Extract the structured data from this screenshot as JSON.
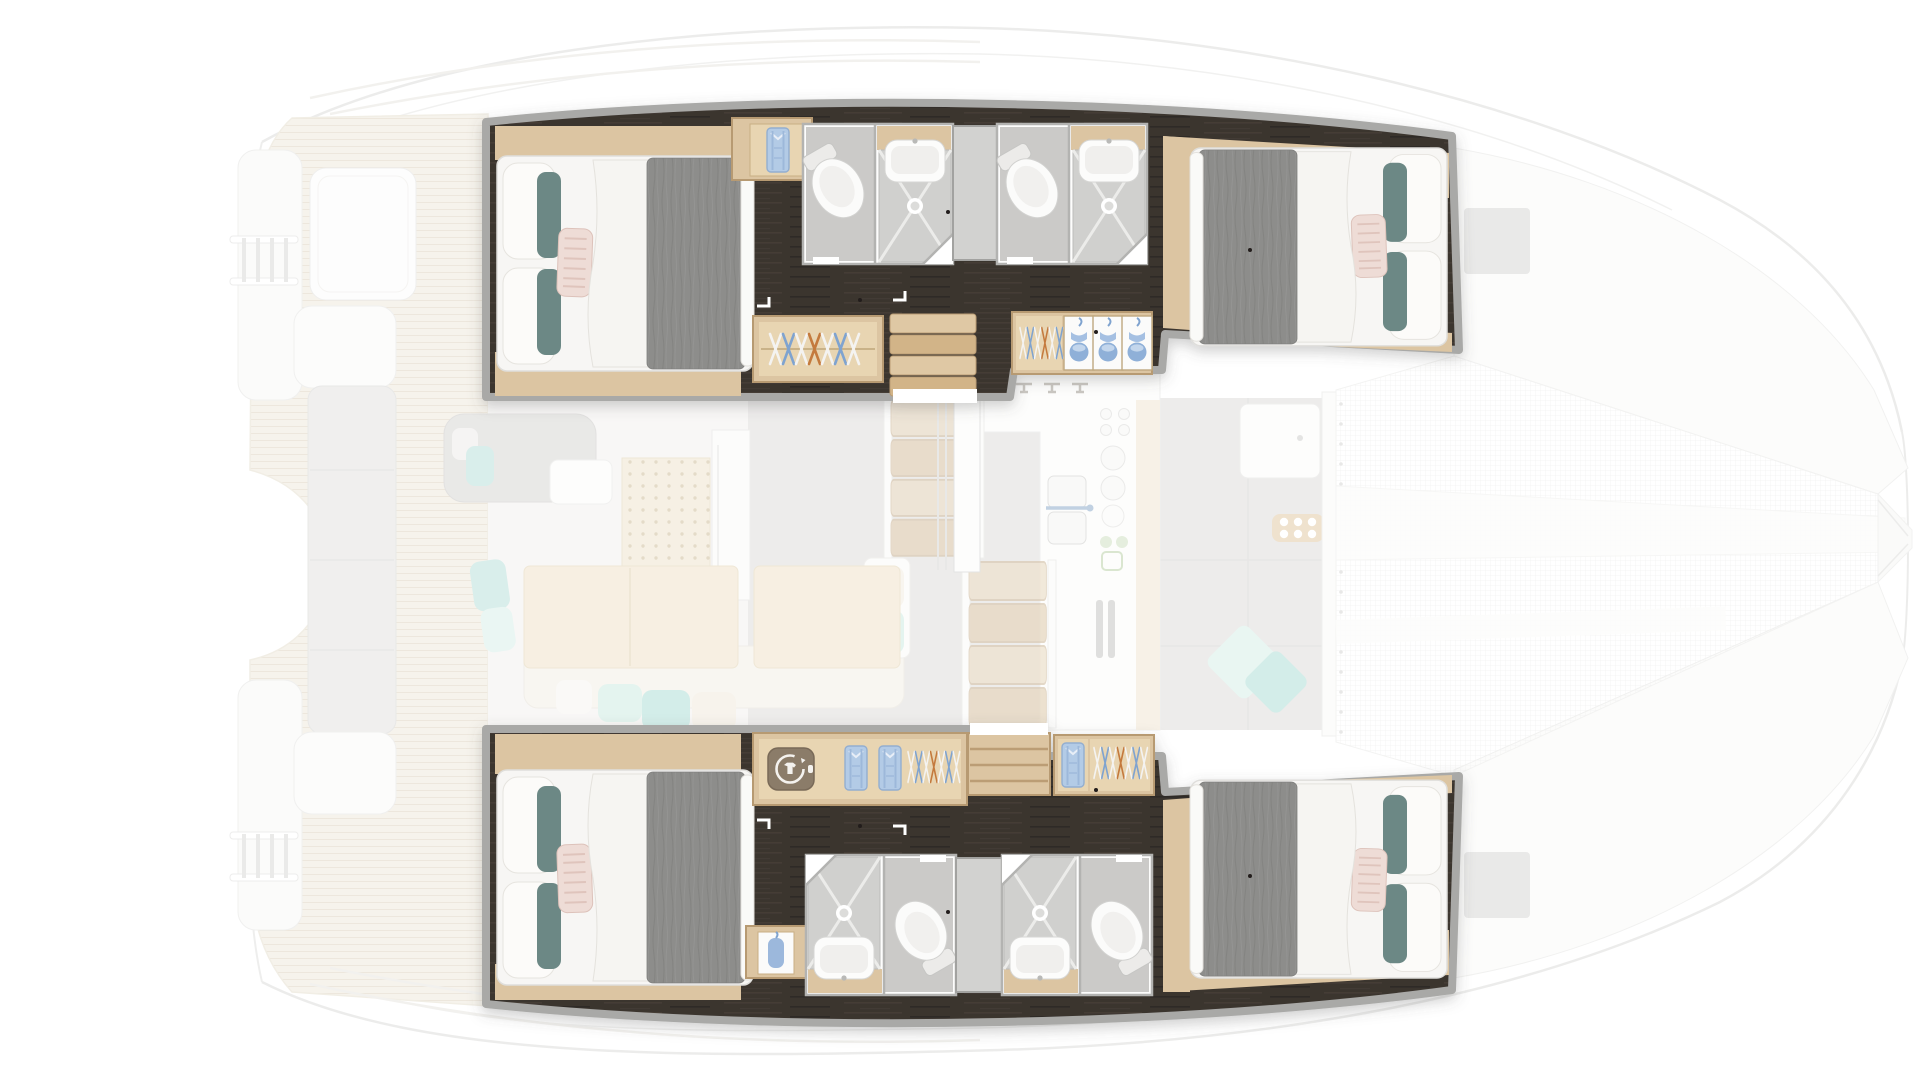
{
  "title": "Catamaran yacht floor plan — 4-cabin version, top view; hull accommodations highlighted, deck and salon ghosted",
  "type": "boat-deck-plan",
  "colors": {
    "wall": "#a9a9a7",
    "floor-dark": "#3b342f",
    "wood": "#dcc5a2",
    "wood-light": "#e8d5b2",
    "wood-deep": "#b79a72",
    "linen": "#f7f6f4",
    "duvet": "#8d8d8b",
    "pillow-teal": "#6c8885",
    "pillow-blush": "#eedcd6",
    "bath-floor": "#cbcac8",
    "shower-tray": "#d0d0ce",
    "divider-door": "#d2d2d0",
    "hanger-blue": "#7fa3cf",
    "hanger-orange": "#c47a3e",
    "shirt-blue": "#b3cbe6",
    "wm-plate": "#8b7b69",
    "teak": "#efe9dc",
    "teak-line": "#ded3bf",
    "salon-gray": "#dddcda",
    "cushion-teal": "#abddd6",
    "cushion-mint": "#cdebe2",
    "table-wood": "#f0e2c8",
    "table-edge": "#e2d2b2",
    "mesh-line": "#e7e7e5",
    "fade-stroke": "#dcdcda"
  },
  "plan": {
    "hulls": [
      {
        "id": "port",
        "position": "top",
        "rooms": [
          {
            "type": "double-cabin",
            "location": "aft",
            "items": [
              "double-bed",
              "gray-duvet",
              "white-duvet-fold",
              "white-pillows",
              "teal-bolster-pillows",
              "striped-blush-pillow",
              "wood-shelf",
              "wood-floor"
            ]
          },
          {
            "type": "closet",
            "items": [
              "folded-blue-shirt"
            ]
          },
          {
            "type": "bathroom",
            "items": [
              "toilet",
              "washbasin",
              "shower-tray",
              "vanity"
            ]
          },
          {
            "type": "sliding-door-panel"
          },
          {
            "type": "bathroom",
            "items": [
              "toilet",
              "washbasin",
              "shower-tray",
              "vanity"
            ]
          },
          {
            "type": "wardrobe",
            "items": [
              "clothes-hangers"
            ]
          },
          {
            "type": "companionway-stairs"
          },
          {
            "type": "wardrobe",
            "items": [
              "clothes-hangers",
              "storage-cubbies-with-blue-items"
            ]
          },
          {
            "type": "double-cabin",
            "location": "forward",
            "items": [
              "double-bed",
              "gray-duvet",
              "white-pillows",
              "teal-bolster-pillows",
              "striped-blush-pillow",
              "wood-shelf"
            ]
          }
        ]
      },
      {
        "id": "starboard",
        "position": "bottom",
        "rooms": [
          {
            "type": "double-cabin",
            "location": "aft",
            "items": [
              "double-bed",
              "gray-duvet",
              "white-duvet-fold",
              "white-pillows",
              "teal-bolster-pillows",
              "striped-blush-pillow",
              "wood-shelf",
              "wood-floor"
            ]
          },
          {
            "type": "wardrobe",
            "items": [
              "washing-machine",
              "folded-blue-shirts",
              "clothes-hangers"
            ]
          },
          {
            "type": "companionway-stairs"
          },
          {
            "type": "wardrobe",
            "items": [
              "folded-blue-shirt",
              "clothes-hangers"
            ]
          },
          {
            "type": "cabinet",
            "items": [
              "blue-bathrobe"
            ]
          },
          {
            "type": "bathroom",
            "items": [
              "shower-tray",
              "washbasin",
              "toilet",
              "vanity"
            ]
          },
          {
            "type": "sliding-door-panel"
          },
          {
            "type": "bathroom",
            "items": [
              "shower-tray",
              "washbasin",
              "toilet",
              "vanity"
            ]
          },
          {
            "type": "double-cabin",
            "location": "forward",
            "items": [
              "double-bed",
              "gray-duvet",
              "white-pillows",
              "teal-bolster-pillows",
              "striped-blush-pillow",
              "wood-shelf"
            ]
          }
        ]
      }
    ],
    "bridgedeck": {
      "salon": [
        "l-shaped-gray-sofa",
        "coffee-table",
        "teal-cushions",
        "perforated-wood-panel",
        "fridge-cabinet",
        "dinette-tables",
        "cream-sofa-with-cushions",
        "side-unit-with-pillows",
        "sliding-door-posts"
      ],
      "galley": [
        "l-shaped-counter",
        "double-sink-with-faucet",
        "cooktop-circles",
        "vent-grilles",
        "wood-veneer-strip",
        "track-fittings"
      ],
      "forward-cockpit": [
        "gray-deck-panels",
        "white-deck-hatch",
        "teal-diamond-cushions",
        "windlass-pad"
      ]
    },
    "exterior": {
      "aft-cockpit": [
        "teak-deck-planks",
        "cockpit-table",
        "bench-seat-cushion",
        "transom-platforms",
        "swim-ladders",
        "coaming-arcs"
      ],
      "foredeck": [
        "trampoline-net",
        "anchor-walkway-bands",
        "bowsprit",
        "gray-deck-hatches",
        "hull-outline-curves",
        "lacing-dots"
      ]
    }
  }
}
